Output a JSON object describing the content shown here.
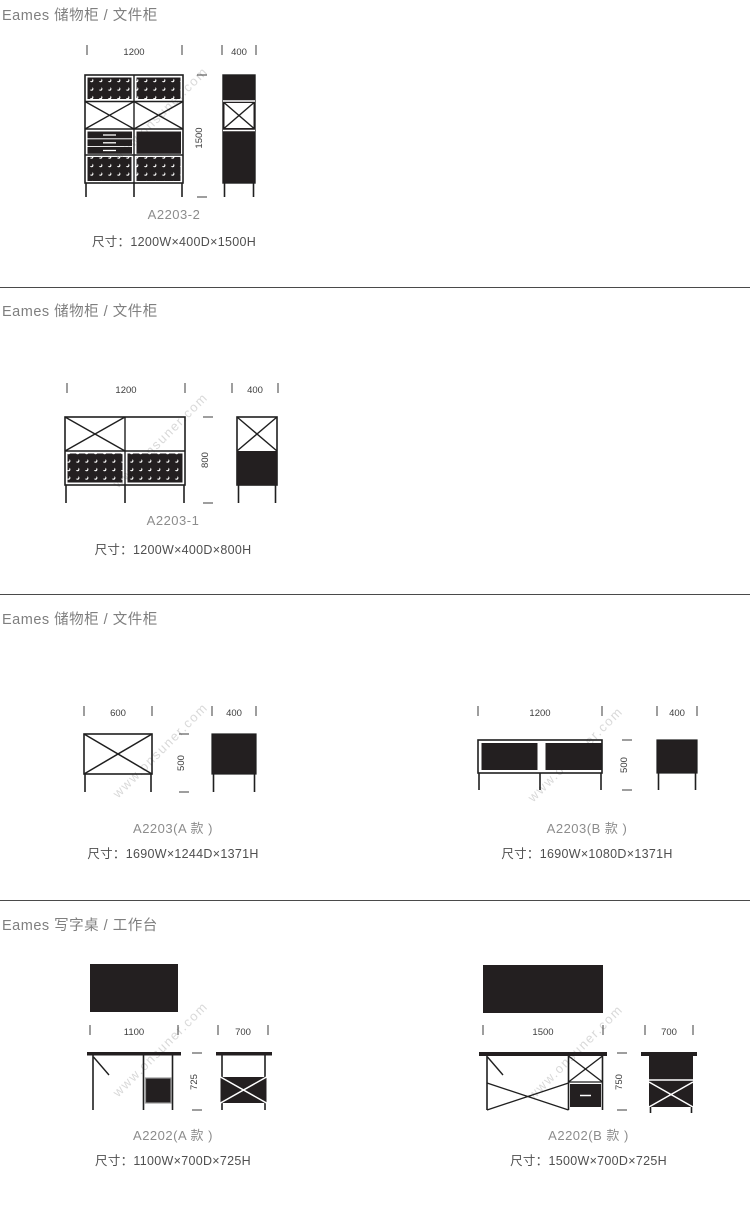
{
  "watermark": {
    "text": "www.onsuner.com",
    "color": "#d9d9d9"
  },
  "colors": {
    "ink": "#1f1f1f",
    "panel_fill": "#231f20",
    "title": "#7f7f7f",
    "model": "#8c8c8c",
    "size": "#4f4f4f",
    "dims": "#3d3d3d",
    "divider": "#4a4a4a"
  },
  "sections": [
    {
      "title": "Eames 储物柜 / 文件柜",
      "products": [
        {
          "model": "A2203-2",
          "size": "尺寸：1200W×400D×1500H",
          "front_width": "1200",
          "side_depth": "400",
          "height": "1500"
        }
      ]
    },
    {
      "title": "Eames 储物柜 / 文件柜",
      "products": [
        {
          "model": "A2203-1",
          "size": "尺寸：1200W×400D×800H",
          "front_width": "1200",
          "side_depth": "400",
          "height": "800"
        }
      ]
    },
    {
      "title": "Eames 储物柜 / 文件柜",
      "products": [
        {
          "model": "A2203(A 款 )",
          "size": "尺寸：1690W×1244D×1371H",
          "front_width": "600",
          "side_depth": "400",
          "height": "500"
        },
        {
          "model": "A2203(B 款 )",
          "size": "尺寸：1690W×1080D×1371H",
          "front_width": "1200",
          "side_depth": "400",
          "height": "500"
        }
      ]
    },
    {
      "title": "Eames 写字桌 / 工作台",
      "products": [
        {
          "model": "A2202(A 款 )",
          "size": "尺寸：1100W×700D×725H",
          "front_width": "1100",
          "side_depth": "700",
          "height": "725"
        },
        {
          "model": "A2202(B 款 )",
          "size": "尺寸：1500W×700D×725H",
          "front_width": "1500",
          "side_depth": "700",
          "height": "750"
        }
      ]
    }
  ]
}
